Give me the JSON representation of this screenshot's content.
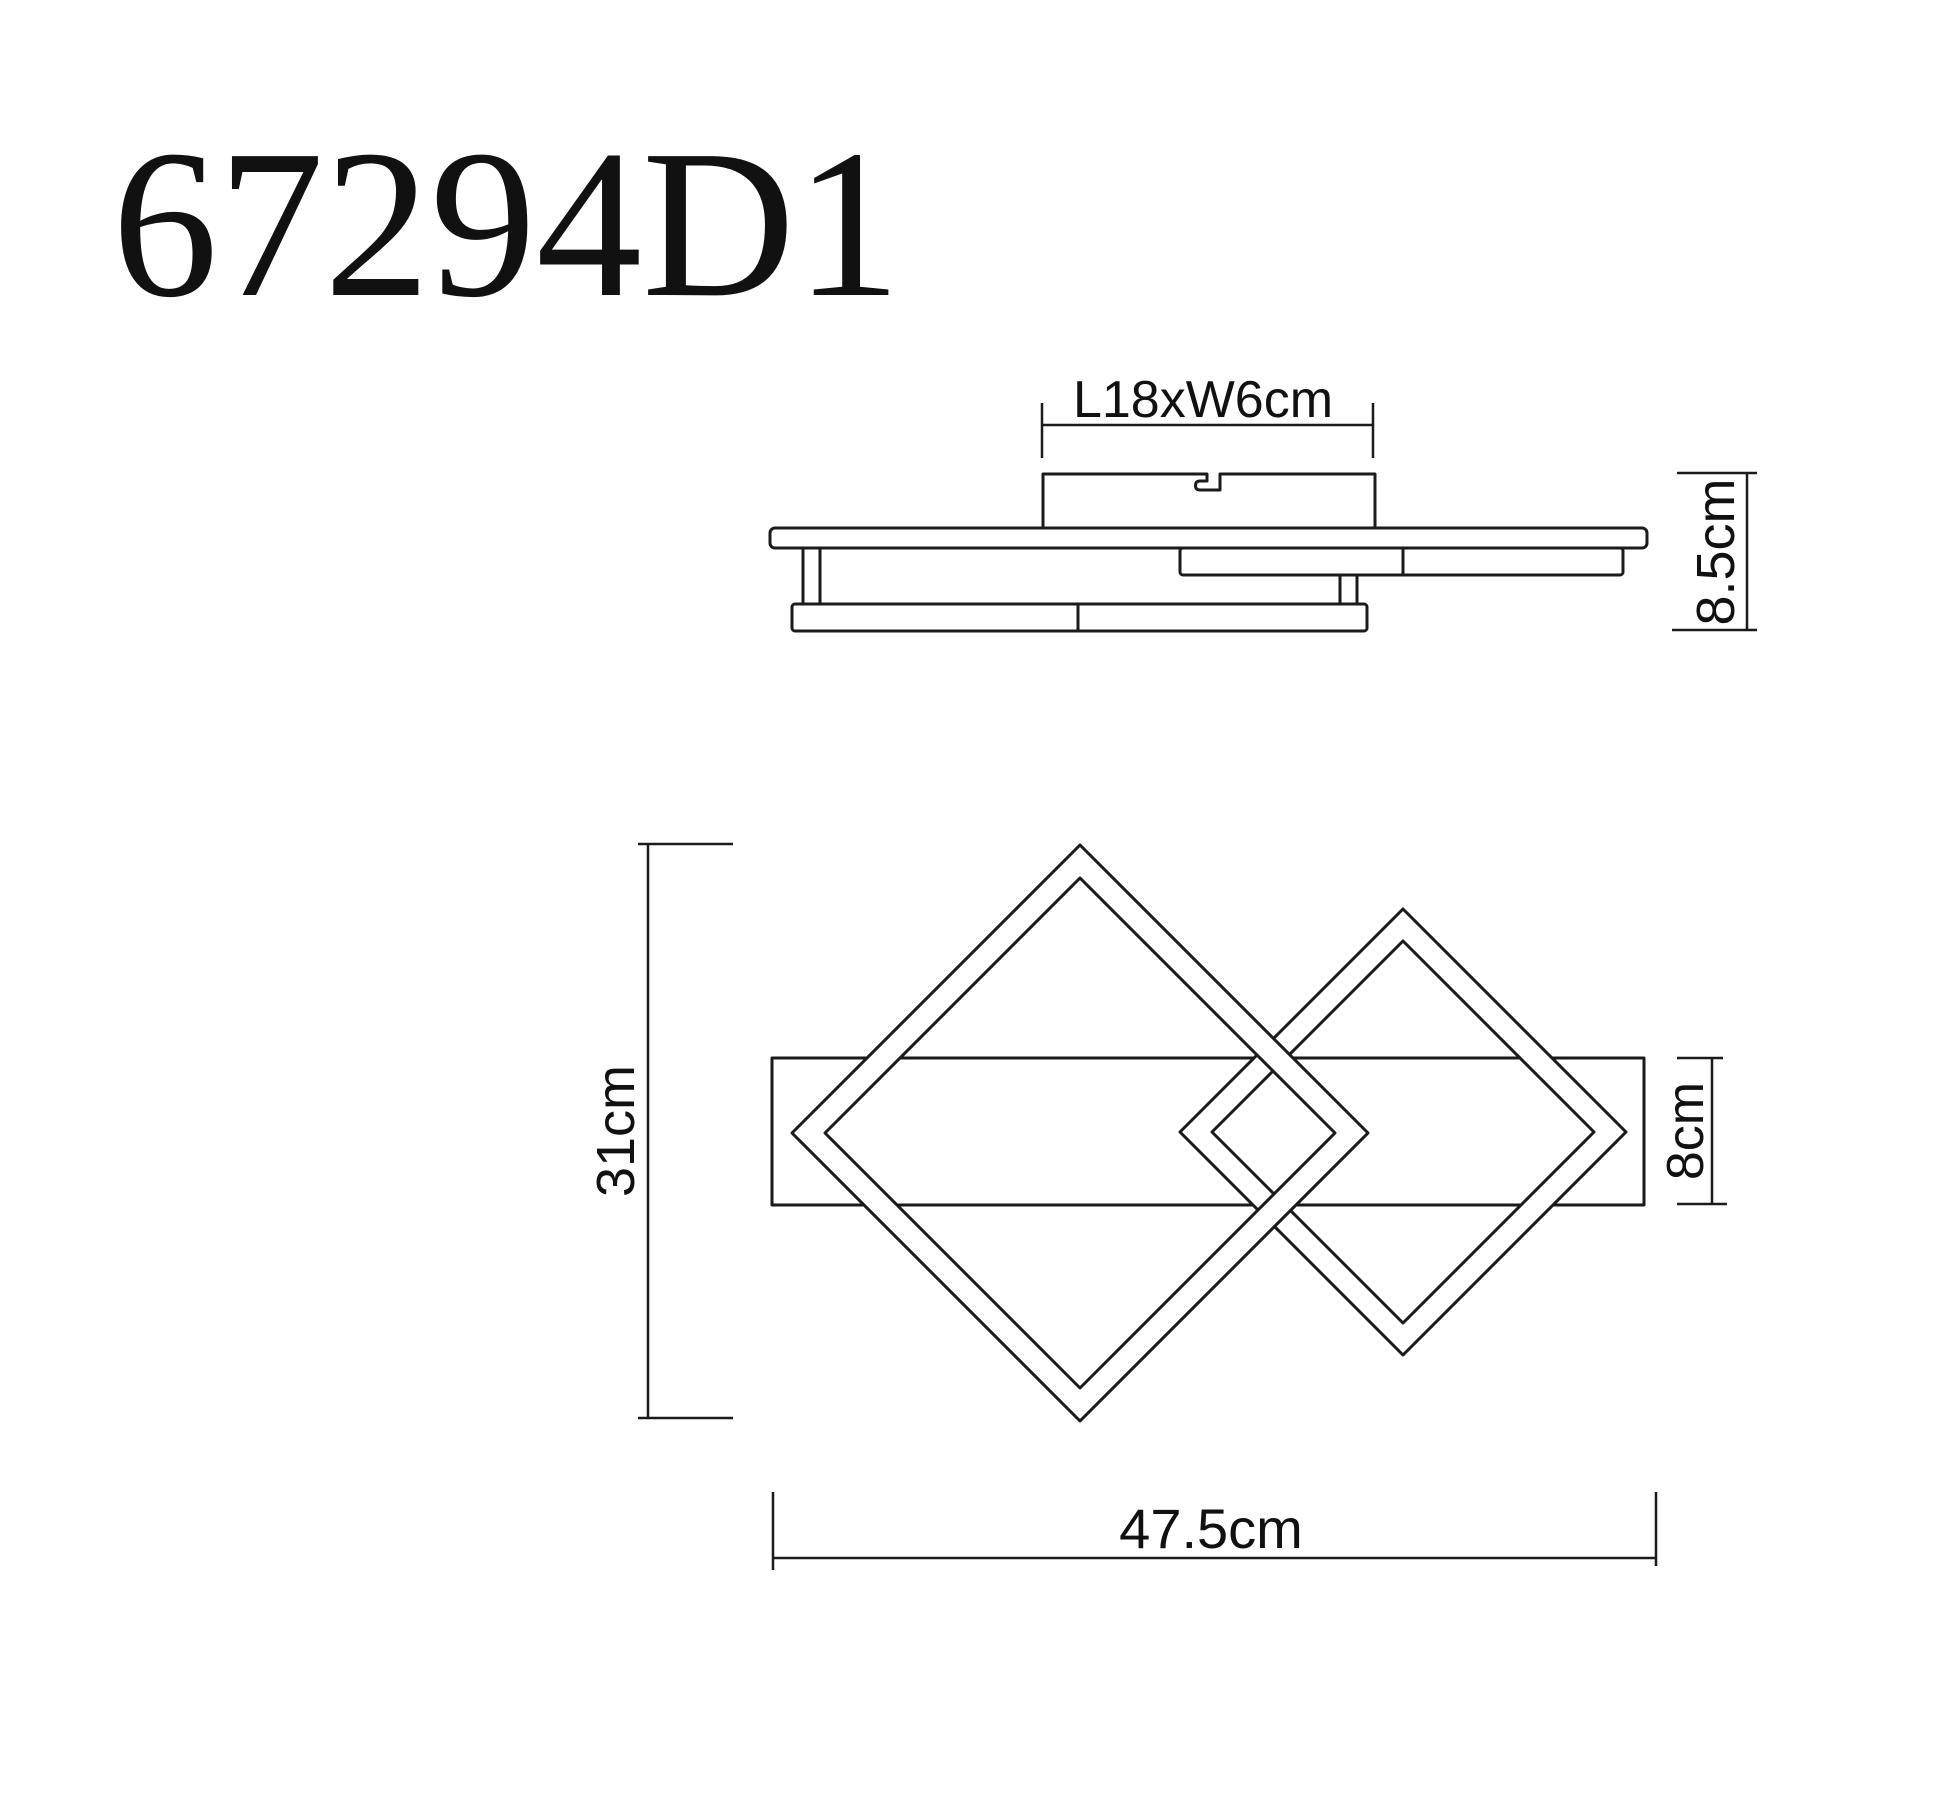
{
  "colors": {
    "background": "#ffffff",
    "line": "#1b1b1b",
    "text": "#111111"
  },
  "title": "67294D1",
  "side_view": {
    "canopy_dim_label": "L18xW6cm",
    "height_dim_label": "8.5cm"
  },
  "plan_view": {
    "overall_height_label": "31cm",
    "bar_height_label": "8cm",
    "overall_width_label": "47.5cm"
  }
}
